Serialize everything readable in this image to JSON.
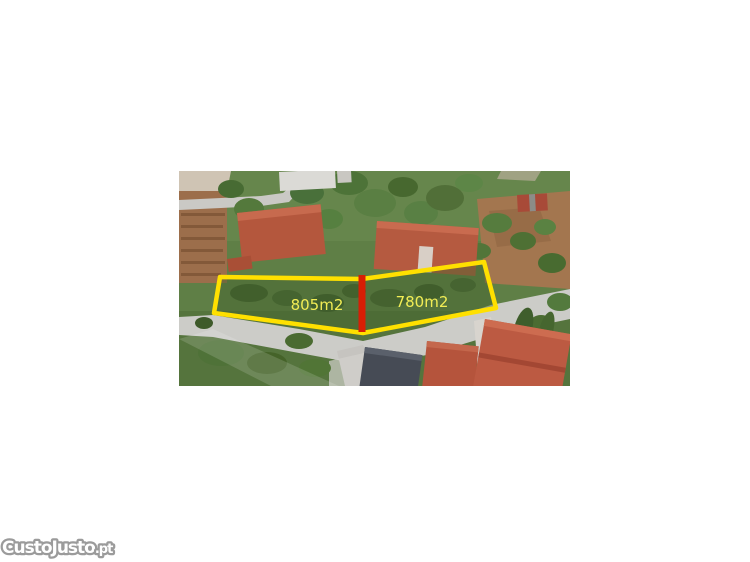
{
  "watermark": {
    "brand": "CustoJusto",
    "suffix": ".pt",
    "outline_color": "#9b9b9b",
    "fill_color": "#ffffff"
  },
  "photo": {
    "parcels": [
      {
        "label": "805m2"
      },
      {
        "label": "780m2"
      }
    ],
    "annotation": {
      "boundary_color": "#ffe000",
      "divider_color": "#d81e05",
      "label_color": "#f1ed55"
    }
  }
}
